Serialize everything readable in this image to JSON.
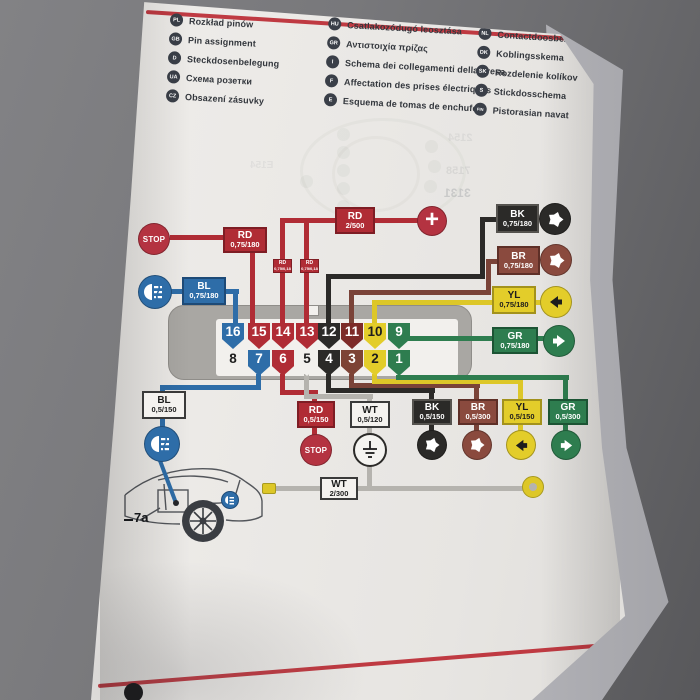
{
  "legend": {
    "columns": [
      {
        "items": [
          {
            "code": "PL",
            "text": "Rozkład pinów"
          },
          {
            "code": "GB",
            "text": "Pin assignment"
          },
          {
            "code": "D",
            "text": "Steckdosenbelegung"
          },
          {
            "code": "UA",
            "text": "Схема розетки"
          },
          {
            "code": "CZ",
            "text": "Obsazení zásuvky"
          }
        ]
      },
      {
        "items": [
          {
            "code": "HU",
            "text": "Csatlakozódugó leosztása"
          },
          {
            "code": "GR",
            "text": "Αντιστοιχία πρίζας"
          },
          {
            "code": "I",
            "text": "Schema dei collegamenti della presa"
          },
          {
            "code": "F",
            "text": "Affectation des prises électriques"
          },
          {
            "code": "E",
            "text": "Esquema de tomas de enchufe"
          }
        ]
      },
      {
        "items": [
          {
            "code": "NL",
            "text": "Contactdoosbezetting"
          },
          {
            "code": "DK",
            "text": "Koblingsskema"
          },
          {
            "code": "SK",
            "text": "Rozdelenie kolíkov"
          },
          {
            "code": "S",
            "text": "Stickdosschema"
          },
          {
            "code": "FIN",
            "text": "Pistorasian navat"
          }
        ]
      }
    ]
  },
  "diagram": {
    "top_labels": {
      "stop": "STOP",
      "rd_main": {
        "name": "RD",
        "spec": "0,75/180"
      },
      "rd_jumper_1": {
        "name": "RD",
        "spec": "0,75/0,18"
      },
      "rd_jumper_2": {
        "name": "RD",
        "spec": "0,75/0,18"
      },
      "rd_power": {
        "name": "RD",
        "spec": "2/500"
      },
      "bl": {
        "name": "BL",
        "spec": "0,75/180"
      },
      "bk": {
        "name": "BK",
        "spec": "0,75/180"
      },
      "br": {
        "name": "BR",
        "spec": "0,75/180"
      },
      "yl": {
        "name": "YL",
        "spec": "0,75/180"
      },
      "gr": {
        "name": "GR",
        "spec": "0,75/180"
      }
    },
    "bottom_labels": {
      "bl": {
        "name": "BL",
        "spec": "0,5/150"
      },
      "rd": {
        "name": "RD",
        "spec": "0,5/150"
      },
      "stop": "STOP",
      "wt": {
        "name": "WT",
        "spec": "0,5/120"
      },
      "bk": {
        "name": "BK",
        "spec": "0,5/150"
      },
      "br": {
        "name": "BR",
        "spec": "0,5/300"
      },
      "yl": {
        "name": "YL",
        "spec": "0,5/150"
      },
      "gr": {
        "name": "GR",
        "spec": "0,5/300"
      },
      "wt_ground": {
        "name": "WT",
        "spec": "2/300"
      }
    },
    "connector": {
      "top_row": [
        {
          "n": "16",
          "color": "blue"
        },
        {
          "n": "15",
          "color": "red"
        },
        {
          "n": "14",
          "color": "red"
        },
        {
          "n": "13",
          "color": "red"
        },
        {
          "n": "12",
          "color": "black"
        },
        {
          "n": "11",
          "color": "darkred"
        },
        {
          "n": "10",
          "color": "yellow"
        },
        {
          "n": "9",
          "color": "green"
        }
      ],
      "bottom_row": [
        {
          "n": "8",
          "color": "white"
        },
        {
          "n": "7",
          "color": "blue"
        },
        {
          "n": "6",
          "color": "red"
        },
        {
          "n": "5",
          "color": "white"
        },
        {
          "n": "4",
          "color": "black"
        },
        {
          "n": "3",
          "color": "brown"
        },
        {
          "n": "2",
          "color": "yellow"
        },
        {
          "n": "1",
          "color": "green"
        }
      ]
    },
    "car_ref": "7a",
    "ghost_texts": [
      "2154",
      "7158",
      "3131",
      "E154"
    ]
  },
  "colors": {
    "accent_red": "#bf3a42",
    "wire_red": "#b02c35",
    "wire_blue": "#2e6da8",
    "wire_black": "#2b2a28",
    "wire_brown": "#7a4338",
    "wire_yellow": "#ddc728",
    "wire_green": "#2e7d4f",
    "wire_white": "#b5b3ae",
    "housing_gray": "#a9a7a3",
    "page": "#ebe9e6",
    "backdrop": "#6f6f72"
  }
}
